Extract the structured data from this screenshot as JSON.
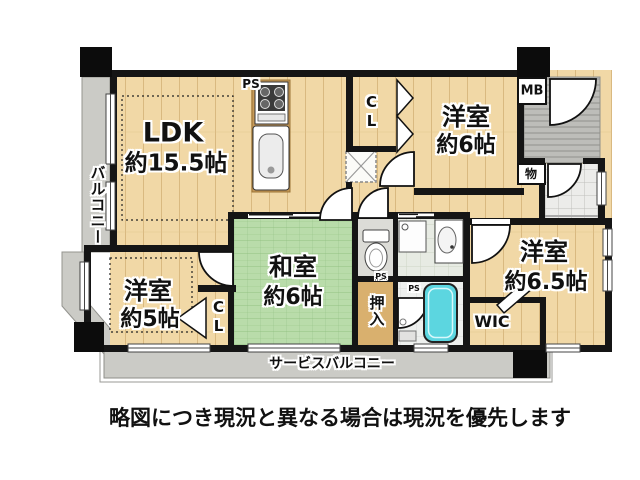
{
  "plan": {
    "rooms": {
      "ldk": {
        "name": "LDK",
        "size": "約15.5帖"
      },
      "western_6": {
        "name": "洋室",
        "size": "約6帖"
      },
      "western_5": {
        "name": "洋室",
        "size": "約5帖"
      },
      "western_65": {
        "name": "洋室",
        "size": "約6.5帖"
      },
      "japanese_6": {
        "name": "和室",
        "size": "約6帖"
      }
    },
    "labels": {
      "balcony": "バルコニー",
      "service_balcony": "サービスバルコニー",
      "closet_top": "CL",
      "closet_bottom": "CL",
      "meter_box": "MB",
      "storage": "物",
      "oshiire": "押入",
      "wic": "WIC",
      "ps_kitchen": "PS",
      "ps_toilet": "PS",
      "ps_bath": "PS"
    },
    "colors": {
      "wood_floor": "#f1d8a6",
      "tatami_green": "#b9dcaa",
      "balcony_gray": "#cbcbc6",
      "bathtub_cyan": "#5cd6e0",
      "wall_black": "#151515"
    }
  },
  "caption": "略図につき現況と異なる場合は現況を優先します"
}
